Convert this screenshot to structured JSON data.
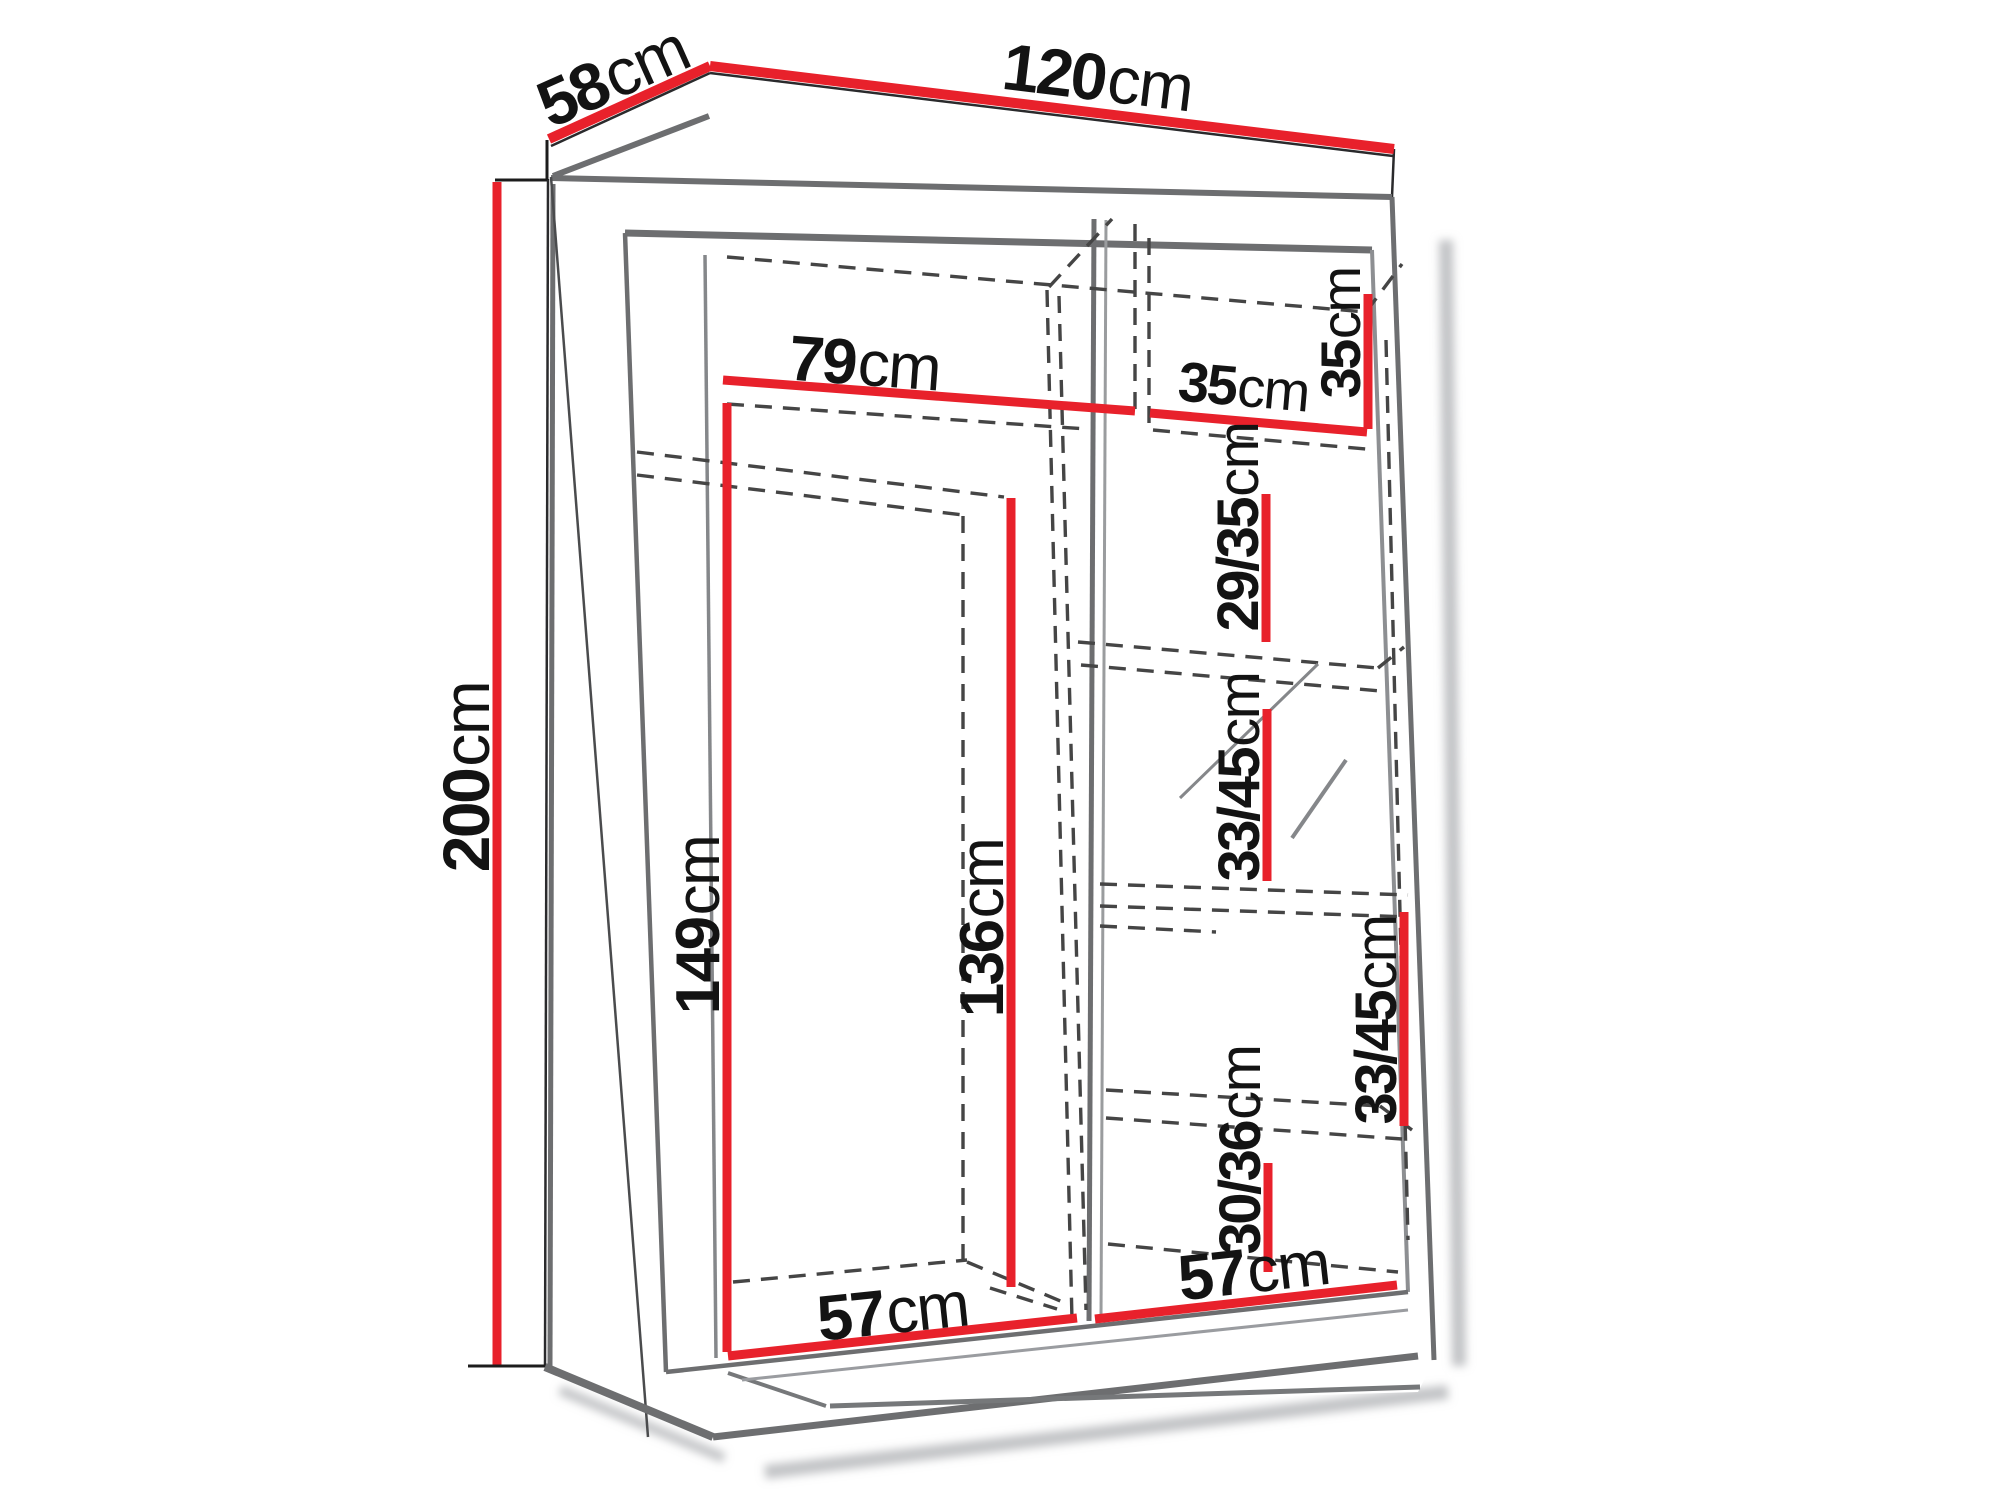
{
  "diagram": {
    "type": "furniture-dimension-diagram",
    "subject": "two-door sliding wardrobe, three-quarter line drawing with internal shelf layout and red dimension lines",
    "unit": "cm",
    "colors": {
      "dimension_accent": "#e8212b",
      "outline": "#2a2a2c",
      "shading": "#6d6e70",
      "hidden_lines": "#454545",
      "background": "#ffffff"
    },
    "dimensions": {
      "overall_width": {
        "num": "120",
        "unit": "cm"
      },
      "overall_depth": {
        "num": "58",
        "unit": "cm"
      },
      "overall_height": {
        "num": "200",
        "unit": "cm"
      },
      "top_shelf_left_width": {
        "num": "79",
        "unit": "cm"
      },
      "top_shelf_right_width": {
        "num": "35",
        "unit": "cm"
      },
      "top_shelf_right_height": {
        "num": "35",
        "unit": "cm"
      },
      "right_gap_upper": {
        "num": "29/35",
        "unit": "cm"
      },
      "right_gap_middle": {
        "num": "33/45",
        "unit": "cm"
      },
      "right_gap_lower": {
        "num": "33/45",
        "unit": "cm"
      },
      "right_gap_bottom": {
        "num": "30/36",
        "unit": "cm"
      },
      "left_interior_height": {
        "num": "149",
        "unit": "cm"
      },
      "left_door_height": {
        "num": "136",
        "unit": "cm"
      },
      "bottom_left_width": {
        "num": "57",
        "unit": "cm"
      },
      "bottom_right_width": {
        "num": "57",
        "unit": "cm"
      }
    }
  }
}
